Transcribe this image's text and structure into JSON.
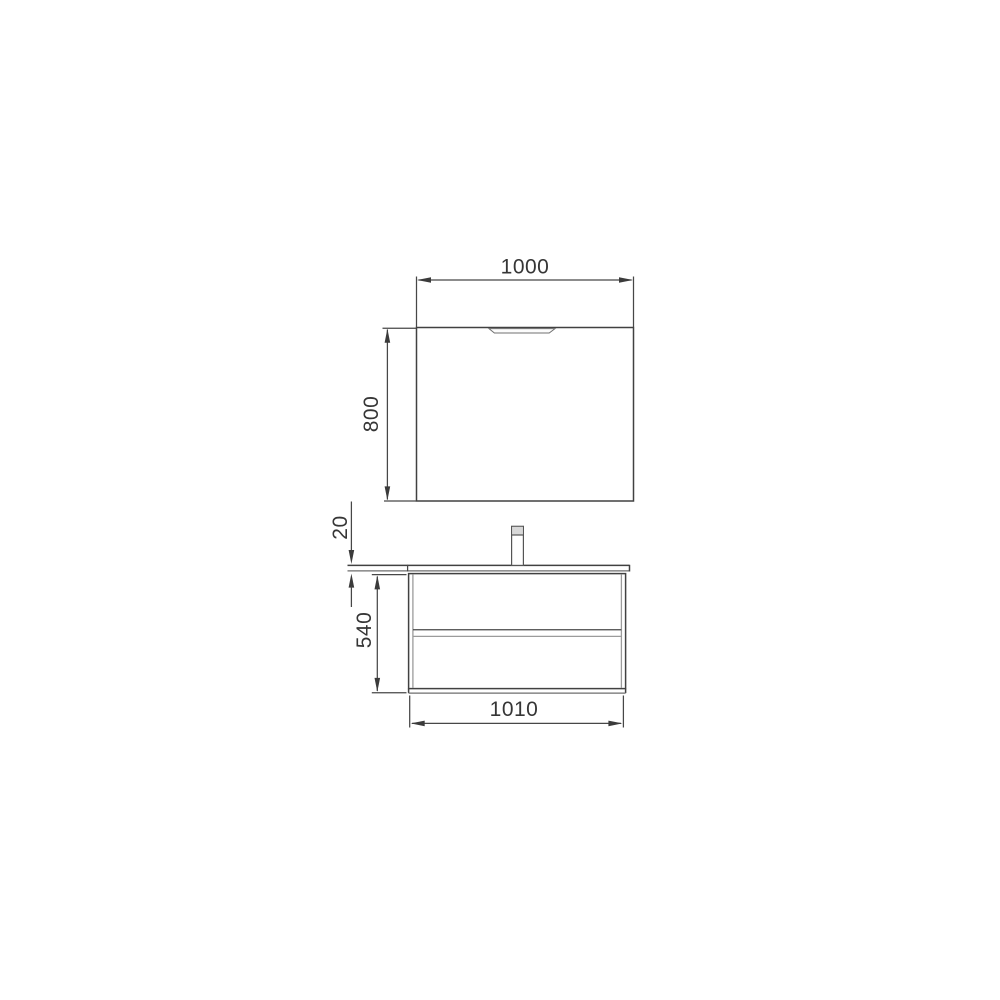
{
  "drawing": {
    "dimensions": {
      "mirror_width": {
        "label": "1000"
      },
      "mirror_height": {
        "label": "800"
      },
      "countertop_thickness": {
        "label": "20"
      },
      "cabinet_height": {
        "label": "540"
      },
      "cabinet_width": {
        "label": "1010"
      }
    },
    "colors": {
      "line_dark": "#414141",
      "line_gray": "#9b9b9b",
      "faucet_cap_fill": "#d8d8d8",
      "background": "#ffffff"
    }
  }
}
